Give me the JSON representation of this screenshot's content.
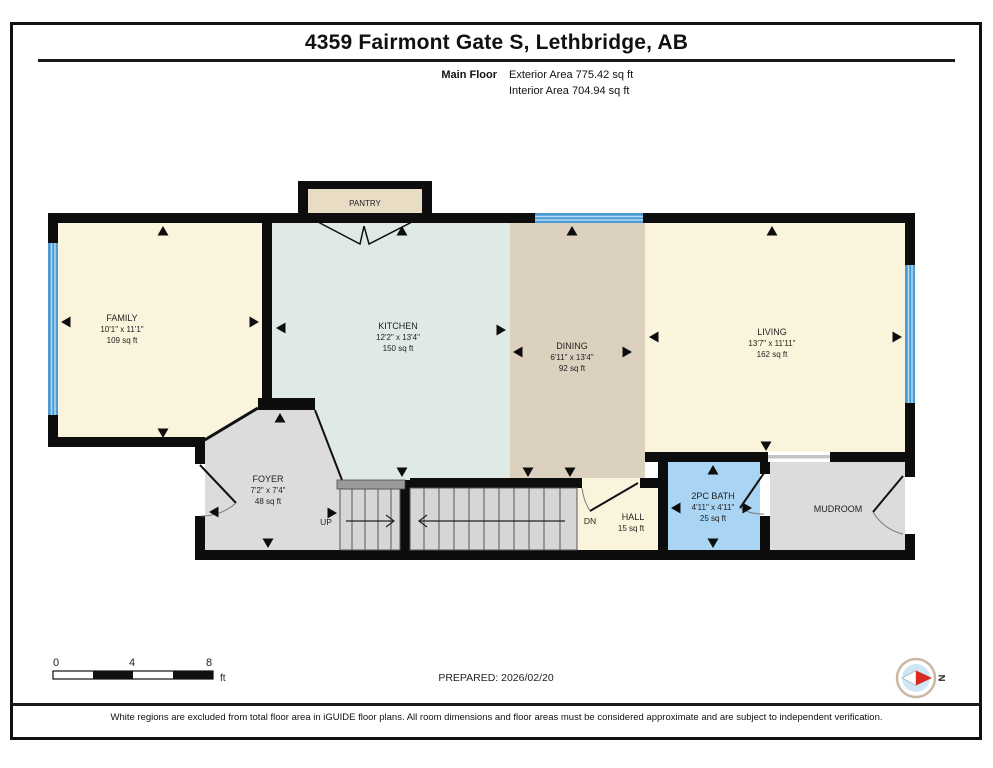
{
  "title": "4359 Fairmont Gate S, Lethbridge, AB",
  "floor_summary": {
    "floor_label": "Main Floor",
    "exterior_area": "Exterior Area 775.42 sq ft",
    "interior_area": "Interior Area 704.94 sq ft"
  },
  "rooms": {
    "family": {
      "name": "FAMILY",
      "dims": "10'1\" x 11'1\"",
      "area": "109 sq ft"
    },
    "kitchen": {
      "name": "KITCHEN",
      "dims": "12'2\" x 13'4\"",
      "area": "150 sq ft"
    },
    "dining": {
      "name": "DINING",
      "dims": "6'11\" x 13'4\"",
      "area": "92 sq ft"
    },
    "living": {
      "name": "LIVING",
      "dims": "13'7\" x 11'11\"",
      "area": "162 sq ft"
    },
    "foyer": {
      "name": "FOYER",
      "dims": "7'2\" x 7'4\"",
      "area": "48 sq ft"
    },
    "bath": {
      "name": "2PC BATH",
      "dims": "4'11\" x 4'11\"",
      "area": "25 sq ft"
    },
    "mudroom": {
      "name": "MUDROOM"
    },
    "hall": {
      "name": "HALL",
      "area": "15 sq ft"
    },
    "pantry": {
      "name": "PANTRY"
    }
  },
  "stairs": {
    "up_label": "UP",
    "down_label": "DN"
  },
  "scale_bar": {
    "tick_0": "0",
    "tick_4": "4",
    "tick_8": "8",
    "unit": "ft"
  },
  "prepared": "PREPARED: 2026/02/20",
  "compass": {
    "north_label": "N"
  },
  "footer": "White regions are excluded from total floor area in iGUIDE floor plans. All room dimensions and floor areas must be considered approximate and are subject to independent verification.",
  "colors": {
    "wall": "#0d0d0d",
    "cream_room": "#fbf4dc",
    "kitchen_mint": "#e0eae4",
    "dining_tan": "#dcd1bf",
    "pantry_tan": "#e9dcc4",
    "gray_room": "#dcdcdc",
    "stairs_gray": "#d6d6d6",
    "bath_blue": "#a9d4f3",
    "window_blue": "#4d9bd5",
    "compass_red": "#d92b21"
  }
}
